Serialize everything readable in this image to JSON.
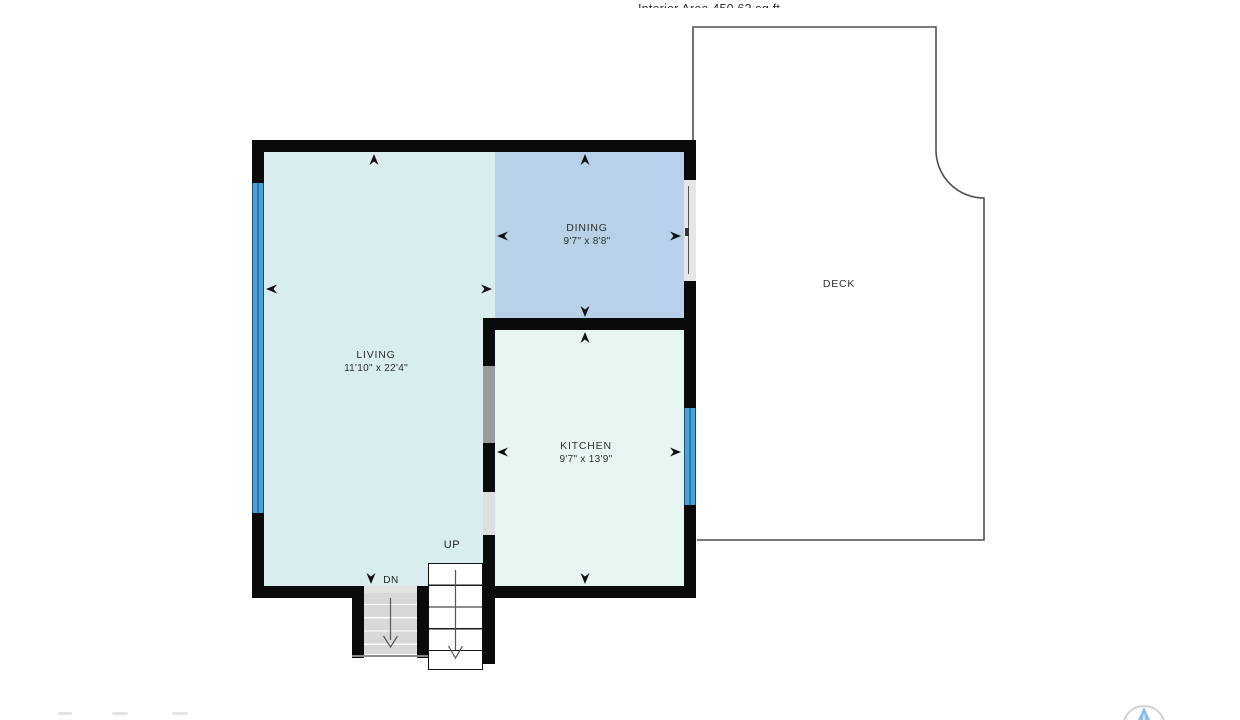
{
  "header": {
    "interior_area": "Interior Area 450.63 sq ft"
  },
  "rooms": {
    "living": {
      "name": "LIVING",
      "dims": "11'10\" x 22'4\""
    },
    "dining": {
      "name": "DINING",
      "dims": "9'7\" x 8'8\""
    },
    "kitchen": {
      "name": "KITCHEN",
      "dims": "9'7\" x 13'9\""
    },
    "deck": {
      "name": "DECK"
    }
  },
  "stairs": {
    "up": "UP",
    "down": "DN"
  },
  "colors": {
    "living_fill": "#d9edef",
    "kitchen_fill": "#e6f4f4",
    "dining_fill": "#b8d1e8",
    "wall": "#0a0a0a",
    "window_blue": "#4aa2d9",
    "door_gray": "#9b9b9b",
    "opening_gray": "#dedede",
    "stairs_gray": "#d8d8d8",
    "deck_outline": "#4f4f4f",
    "logo_blue": "#8abde8"
  }
}
